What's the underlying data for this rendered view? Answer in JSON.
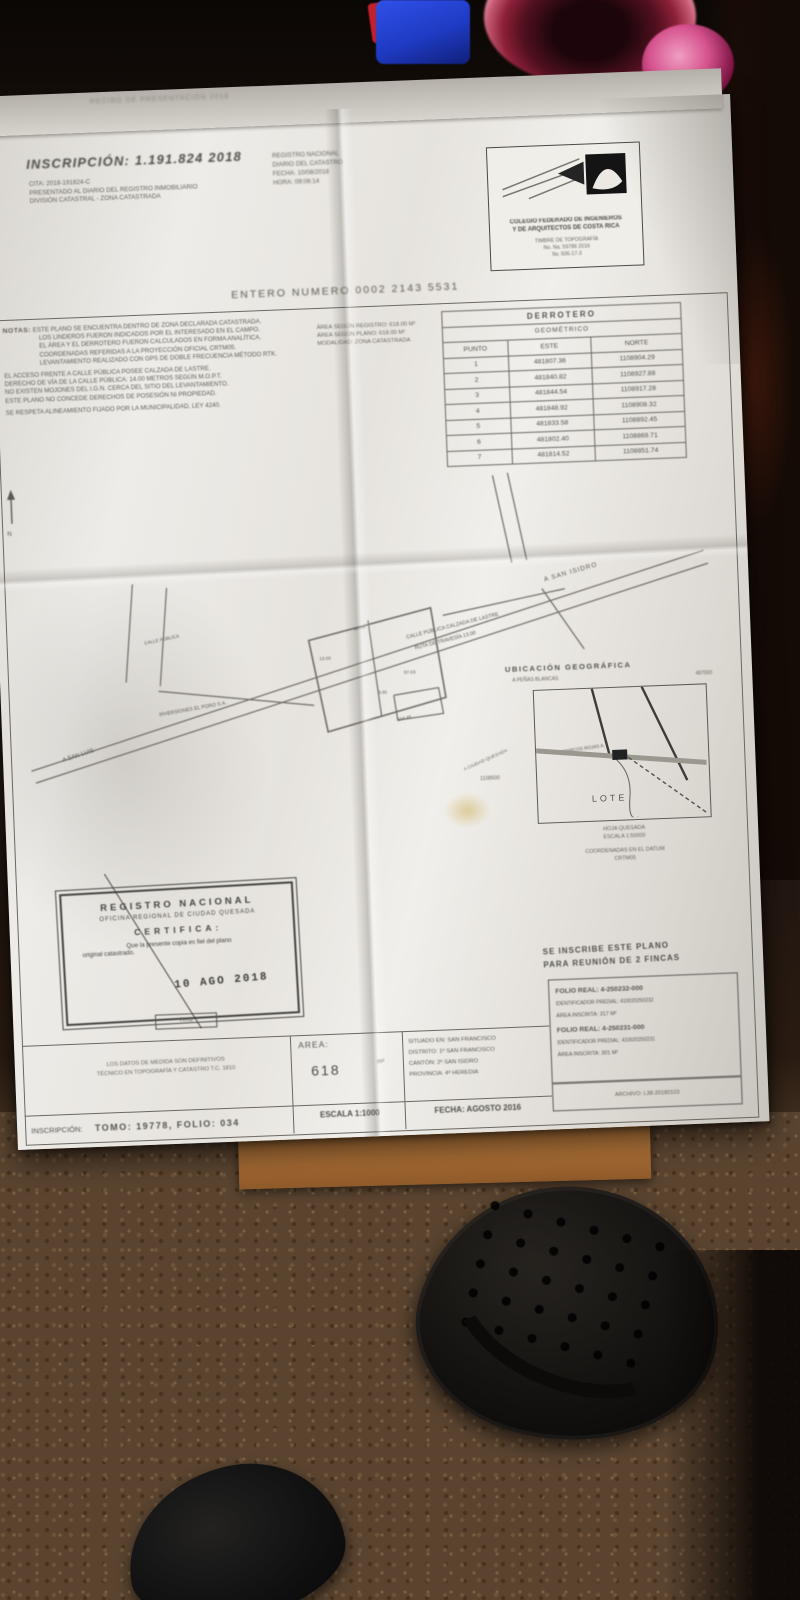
{
  "scene": {
    "description": "photo of a cadastral survey plan lying on a dark floor",
    "colors": {
      "carpet": "#5a4430",
      "paper": "#eeece8",
      "envelope": "#c08040",
      "drink": "#c2566f",
      "sandal": "#141210"
    }
  },
  "document": {
    "back_sheet_text": "RECIBO DE PRESENTACIÓN 2018",
    "header": {
      "title": "INSCRIPCIÓN: 1.191.824 2018",
      "left_lines": [
        "CITA: 2018-191824-C",
        "PRESENTADO AL DIARIO DEL REGISTRO INMOBILIARIO",
        "DIVISIÓN CATASTRAL - ZONA CATASTRADA"
      ],
      "right_lines": [
        "REGISTRO NACIONAL",
        "DIARIO DEL CATASTRO",
        "FECHA: 10/08/2018",
        "HORA: 09:06:14"
      ]
    },
    "logo_box": {
      "bold_lines": [
        "COLEGIO FEDERADO DE INGENIEROS",
        "Y DE ARQUITECTOS DE COSTA RICA"
      ],
      "small_lines": [
        "TIMBRE DE TOPOGRAFÍA",
        "No. Na. 59786 2016",
        "Nv. 506-17-3"
      ]
    },
    "entero": "ENTERO NUMERO 0002 2143 5531",
    "notas": {
      "label": "NOTAS:",
      "lines": [
        "ESTE PLANO SE ENCUENTRA DENTRO DE ZONA DECLARADA CATASTRADA.",
        "LOS LINDEROS FUERON INDICADOS POR EL INTERESADO EN EL CAMPO.",
        "EL ÁREA Y EL DERROTERO FUERON CALCULADOS EN FORMA ANALÍTICA.",
        "COORDENADAS REFERIDAS A LA PROYECCIÓN OFICIAL CRTM05.",
        "LEVANTAMIENTO REALIZADO CON GPS DE DOBLE FRECUENCIA MÉTODO RTK.",
        "EL ACCESO FRENTE A CALLE PÚBLICA POSEE CALZADA DE LASTRE.",
        "DERECHO DE VÍA DE LA CALLE PÚBLICA: 14.00 METROS SEGÚN M.O.P.T.",
        "NO EXISTEN MOJONES DEL I.G.N. CERCA DEL SITIO DEL LEVANTAMIENTO.",
        "ESTE PLANO NO CONCEDE DERECHOS DE POSESIÓN NI PROPIEDAD.",
        "SE RESPETA ALINEAMIENTO FIJADO POR LA MUNICIPALIDAD, LEY 4240."
      ],
      "side_lines": [
        "ÁREA SEGÚN REGISTRO: 618.00 M²",
        "ÁREA SEGÚN PLANO: 618.00 M²",
        "MODALIDAD: ZONA CATASTRADA"
      ]
    },
    "derrotero": {
      "title": "DERROTERO",
      "subtitle": "GEOMÉTRICO",
      "headers": [
        "PUNTO",
        "ESTE",
        "NORTE"
      ],
      "rows": [
        {
          "p": "1",
          "e": "481807.36",
          "n": "1108904.29"
        },
        {
          "p": "2",
          "e": "481840.82",
          "n": "1108927.88"
        },
        {
          "p": "3",
          "e": "481844.54",
          "n": "1108917.28"
        },
        {
          "p": "4",
          "e": "481848.92",
          "n": "1108908.32"
        },
        {
          "p": "5",
          "e": "481833.58",
          "n": "1108892.45"
        },
        {
          "p": "6",
          "e": "481802.40",
          "n": "1108869.71"
        },
        {
          "p": "7",
          "e": "481814.52",
          "n": "1108851.74"
        }
      ]
    },
    "map": {
      "labels": {
        "a_san_isidro": "A SAN ISIDRO",
        "a_san_luis": "A SAN LUIS",
        "calle_line1": "CALLE PÚBLICA CALZADA DE LASTRE",
        "calle_line2": "RUTA DE TRAVESÍA 13.00",
        "calle_left": "CALLE PÚBLICA",
        "neighbor_left": "INVERSIONES EL PORO S.A.",
        "neighbor_bottom": "MARCOS ROJAS A.",
        "north": "N"
      },
      "dims": [
        "64.64",
        "13.00",
        "57.03",
        "5.60",
        "104.45"
      ]
    },
    "ubicacion": {
      "title": "UBICACIÓN GEOGRÁFICA",
      "subtitle": "A PEÑAS BLANCAS",
      "coord_top": "487000",
      "coord_left": "1108500",
      "lote": "LOTE",
      "road_label": "A CIUDAD QUESADA",
      "foot_lines": [
        "HOJA QUESADA",
        "ESCALA 1:50000"
      ],
      "foot_lines2": [
        "COORDENADAS EN EL DATUM",
        "CRTM05"
      ]
    },
    "stamp": {
      "lines": [
        "REGISTRO NACIONAL",
        "OFICINA REGIONAL DE CIUDAD QUESADA",
        "CERTIFICA:",
        "Que la presente copia es fiel del plano",
        "original catastrado."
      ],
      "date": "10 AGO 2018",
      "firma": "Firma"
    },
    "inscribe": {
      "line1": "SE INSCRIBE ESTE PLANO",
      "line2": "PARA REUNIÓN DE 2 FINCAS"
    },
    "folio": {
      "lines": [
        "FOLIO REAL: 4-250232-000",
        "IDENTIFICADOR PREDIAL: 410020250232",
        "ÁREA INSCRITA: 317 M²",
        "FOLIO REAL: 4-250231-000",
        "IDENTIFICADOR PREDIAL: 410020250231",
        "ÁREA INSCRITA: 301 M²"
      ],
      "archivo": "ARCHIVO: L38-20180103"
    },
    "bottom": {
      "tech_lines": [
        "LOS DATOS DE MEDIDA SON DEFINITIVOS",
        "TÉCNICO EN TOPOGRAFÍA Y CATASTRO T.C. 1810"
      ],
      "inscripcion_label": "INSCRIPCIÓN:",
      "tomo_folio": "TOMO: 19778, FOLIO: 034",
      "area_label": "AREA:",
      "area_value": "618",
      "area_unit": "m²",
      "escala": "ESCALA 1:1000",
      "situado": [
        "SITUADO EN: SAN FRANCISCO",
        "DISTRITO: 1º SAN FRANCISCO",
        "CANTÓN: 2º SAN ISIDRO",
        "PROVINCIA: 4º HEREDIA"
      ],
      "fecha": "FECHA: AGOSTO 2016"
    }
  }
}
